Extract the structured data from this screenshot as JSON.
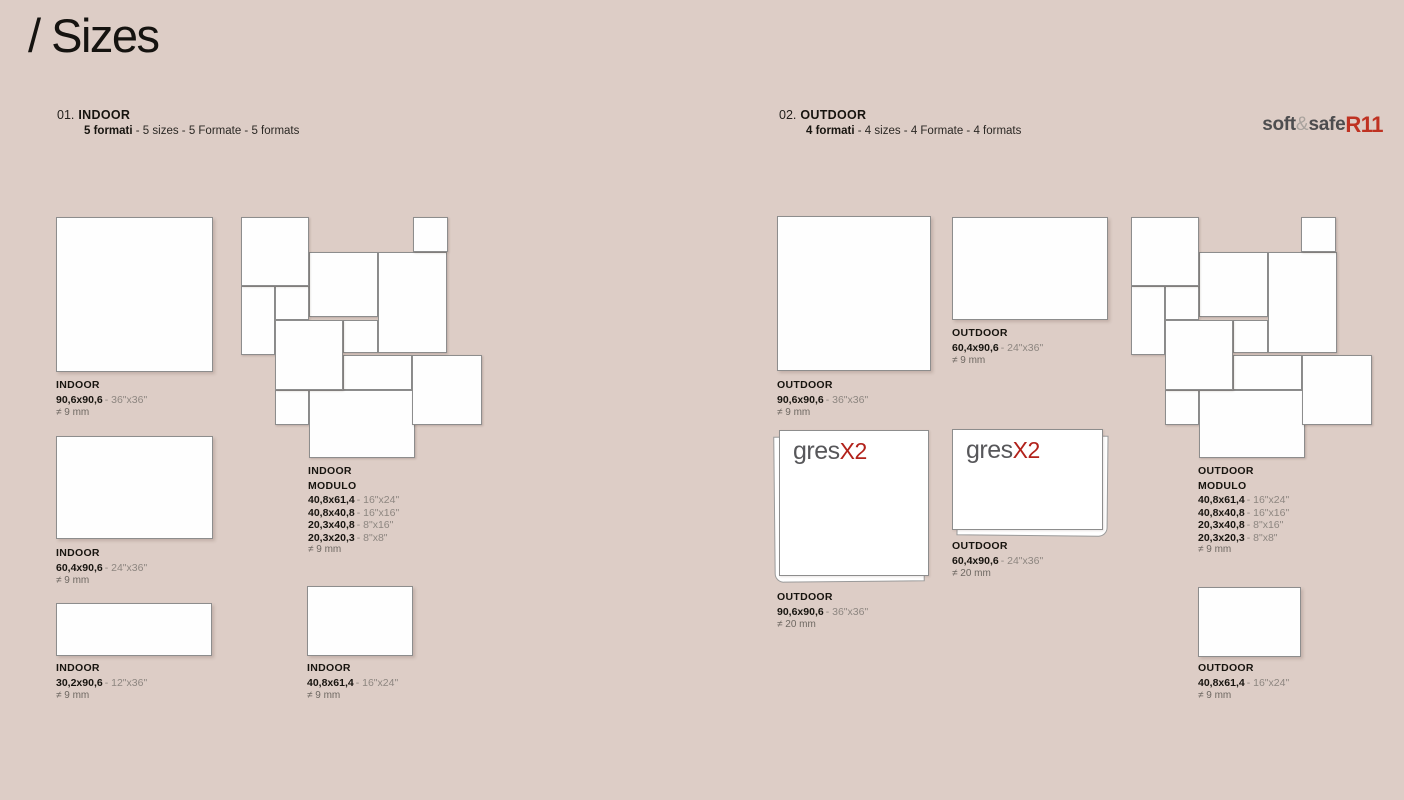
{
  "page": {
    "title": "/ Sizes"
  },
  "sections": {
    "indoor": {
      "number": "01.",
      "name": "INDOOR",
      "formats_bold": "5 formati",
      "formats_rest": "- 5 sizes - 5 Formate - 5 formats"
    },
    "outdoor": {
      "number": "02.",
      "name": "OUTDOOR",
      "formats_bold": "4 formati",
      "formats_rest": "- 4 sizes - 4 Formate - 4 formats"
    }
  },
  "brand": {
    "soft": "soft",
    "amp": "&",
    "safe": "safe",
    "rating": "R11"
  },
  "gres": {
    "name": "gres",
    "x2": "X2"
  },
  "labels": {
    "indoor_90": {
      "category": "INDOOR",
      "size": "90,6x90,6",
      "inches": "- 36\"x36\"",
      "thickness": "≠ 9 mm"
    },
    "indoor_60": {
      "category": "INDOOR",
      "size": "60,4x90,6",
      "inches": "- 24\"x36\"",
      "thickness": "≠ 9 mm"
    },
    "indoor_30": {
      "category": "INDOOR",
      "size": "30,2x90,6",
      "inches": "- 12\"x36\"",
      "thickness": "≠ 9 mm"
    },
    "indoor_40": {
      "category": "INDOOR",
      "size": "40,8x61,4",
      "inches": "- 16\"x24\"",
      "thickness": "≠ 9 mm"
    },
    "indoor_modulo": {
      "category": "INDOOR",
      "title": "MODULO",
      "rows": [
        {
          "size": "40,8x61,4",
          "inches": "- 16\"x24\""
        },
        {
          "size": "40,8x40,8",
          "inches": "- 16\"x16\""
        },
        {
          "size": "20,3x40,8",
          "inches": "- 8\"x16\""
        },
        {
          "size": "20,3x20,3",
          "inches": "- 8\"x8\""
        }
      ],
      "thickness": "≠ 9 mm"
    },
    "outdoor_90": {
      "category": "OUTDOOR",
      "size": "90,6x90,6",
      "inches": "- 36\"x36\"",
      "thickness": "≠ 9 mm"
    },
    "outdoor_60": {
      "category": "OUTDOOR",
      "size": "60,4x90,6",
      "inches": "- 24\"x36\"",
      "thickness": "≠ 9 mm"
    },
    "outdoor_modulo": {
      "category": "OUTDOOR",
      "title": "MODULO",
      "rows": [
        {
          "size": "40,8x61,4",
          "inches": "- 16\"x24\""
        },
        {
          "size": "40,8x40,8",
          "inches": "- 16\"x16\""
        },
        {
          "size": "20,3x40,8",
          "inches": "- 8\"x16\""
        },
        {
          "size": "20,3x20,3",
          "inches": "- 8\"x8\""
        }
      ],
      "thickness": "≠ 9 mm"
    },
    "outdoor_90_x2": {
      "category": "OUTDOOR",
      "size": "90,6x90,6",
      "inches": "- 36\"x36\"",
      "thickness": "≠ 20 mm"
    },
    "outdoor_60_x2": {
      "category": "OUTDOOR",
      "size": "60,4x90,6",
      "inches": "- 24\"x36\"",
      "thickness": "≠ 20 mm"
    },
    "outdoor_40": {
      "category": "OUTDOOR",
      "size": "40,8x61,4",
      "inches": "- 16\"x24\"",
      "thickness": "≠ 9 mm"
    }
  },
  "colors": {
    "background": "#ddcdc6",
    "tile_fill": "#fefefe",
    "tile_border": "#8d8d8d",
    "text_dark": "#17140f",
    "text_gray": "#8d8680",
    "brand_gray": "#4d4d4f",
    "accent_red": "#bf3222",
    "gres_red": "#b2221b"
  }
}
